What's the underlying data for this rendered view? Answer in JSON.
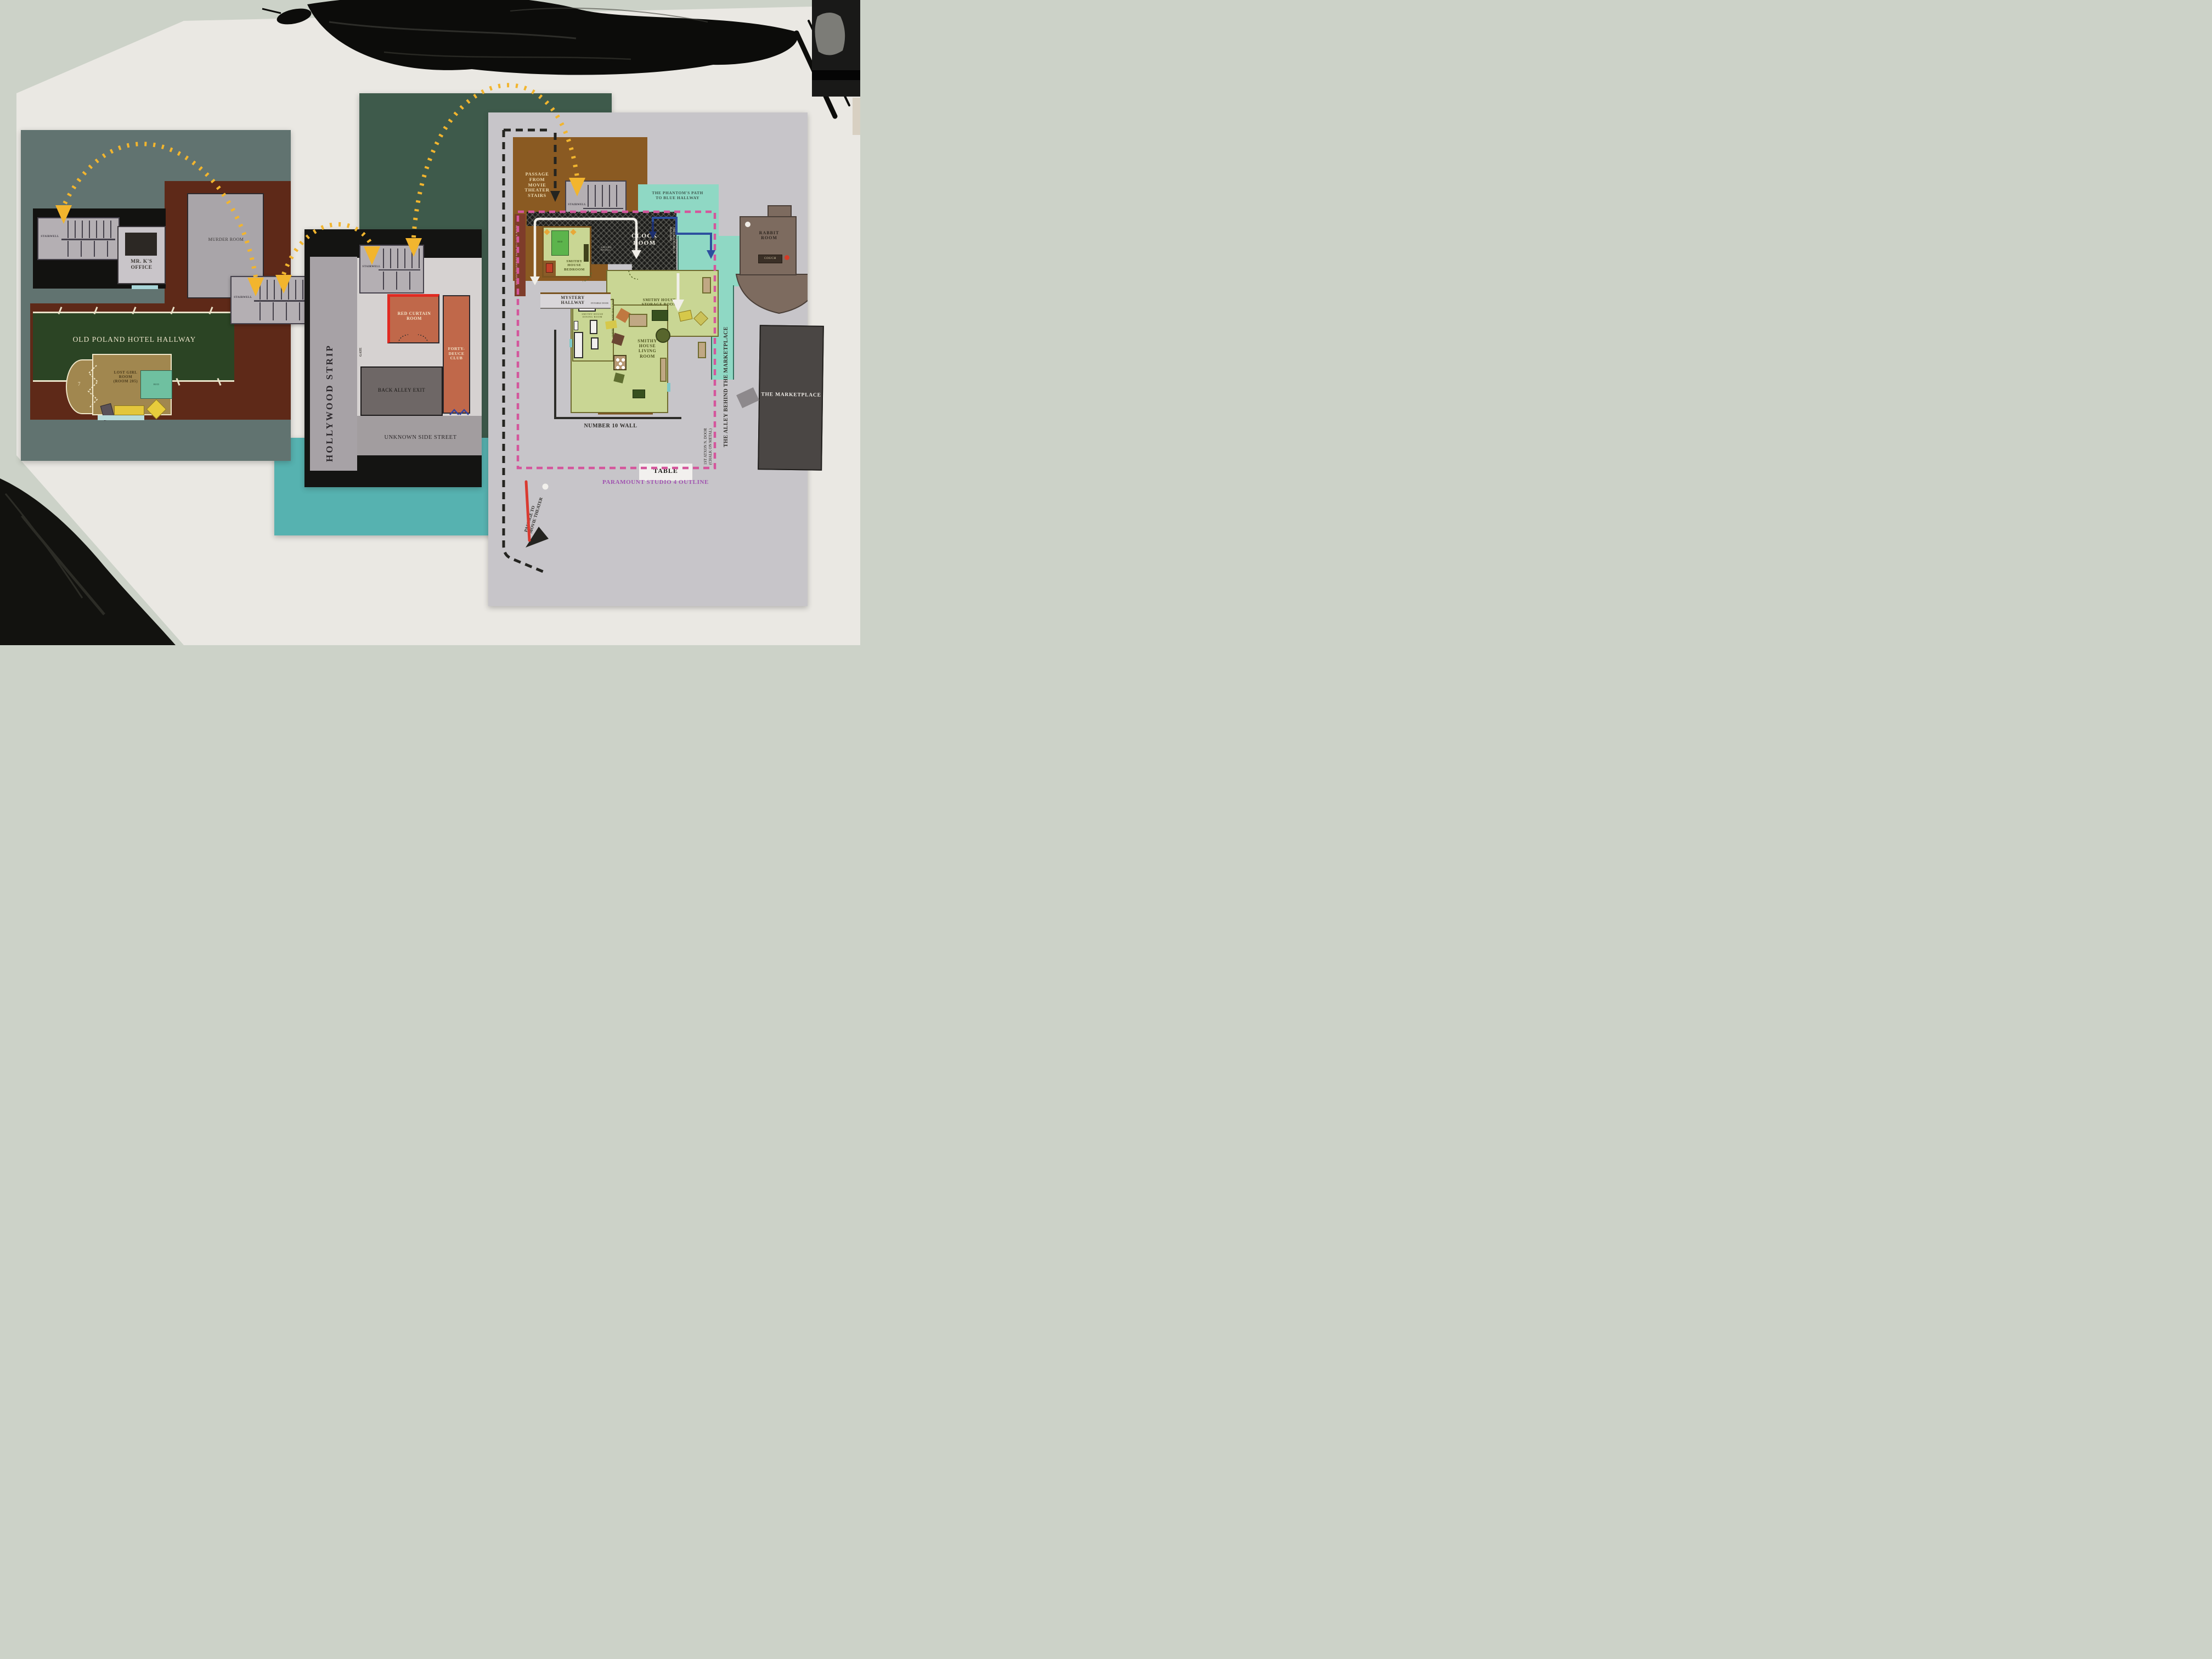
{
  "left_map": {
    "stairwell_top": "STAIRWELL",
    "stairwell_mid": "STAIRWELL",
    "mr_k_office": "MR. K'S\nOFFICE",
    "murder_room": "MURDER ROOM",
    "hallway": "OLD POLAND HOTEL HALLWAY",
    "lost_girl_room": "LOST GIRL\nROOM\n(ROOM 205)",
    "bed": "BED",
    "room_number": "7"
  },
  "middle_map": {
    "strip": "HOLLYWOOD STRIP",
    "stairwell": "STAIRWELL",
    "red_curtain_room": "RED CURTAIN\nROOM",
    "forty_deuce_club": "FORTY-\nDEUCE\nCLUB",
    "gate": "GATE",
    "back_alley_exit": "BACK ALLEY EXIT",
    "unknown_side_street": "UNKNOWN SIDE STREET"
  },
  "right_map": {
    "passage_from_theater": "PASSAGE\nFROM\nMOVIE\nTHEATER\nSTAIRS",
    "instant_transport": "INSTANT TRANSPORT BACK TO CLOCK ROOM",
    "stairwell": "STAIRWELL",
    "phantom_path": "THE PHANTOM'S PATH\nTO BLUE HALLWAY",
    "clock_room": "CLOCK\nROOM",
    "saturn_decal": "SATURN\nDECAL",
    "clock": "CLOCK",
    "passage_blue_hallway": "PASSAGE TO BLUE HALLWAY",
    "rabbit_room": "RABBIT\nROOM",
    "couch": "COUCH",
    "mystery_hallway": "MYSTERY\nHALLWAY",
    "invisible_door": "INVISIBLE DOOR",
    "smithy_bedroom": "SMITHY\nHOUSE\nBEDROOM",
    "bed": "BED",
    "smithy_hallway": "SMITHY HOUSE HALLWAY",
    "storage_room": "SMITHY HOUSE\nSTORAGE ROOM",
    "dining_room": "SMITHY HOUSE\nDINING ROOM",
    "dining_table": "TABLE",
    "living_room": "SMITHY\nHOUSE\nLIVING\nROOM",
    "number_10_wall": "NUMBER 10 WALL",
    "table_box": "TABLE",
    "marketplace": "THE MARKETPLACE",
    "alley": "THE ALLEY BEHIND THE MARKETPLACE",
    "arxon_door": "1ST ATXON N. DOOR\n(CHALK ON METAL)",
    "studio_outline": "PARAMOUNT STUDIO 4 OUTLINE",
    "passage_to_theater": "PASSAGE TO\nMOVIE THEATER"
  },
  "colors": {
    "arrow_yellow": "#f2b52e",
    "outline_pink": "#d4569c",
    "outline_black": "#242420",
    "phantom_blue": "#2c4f9e",
    "passage_red": "#d93a30",
    "studio_outline_text": "#a052b0"
  }
}
